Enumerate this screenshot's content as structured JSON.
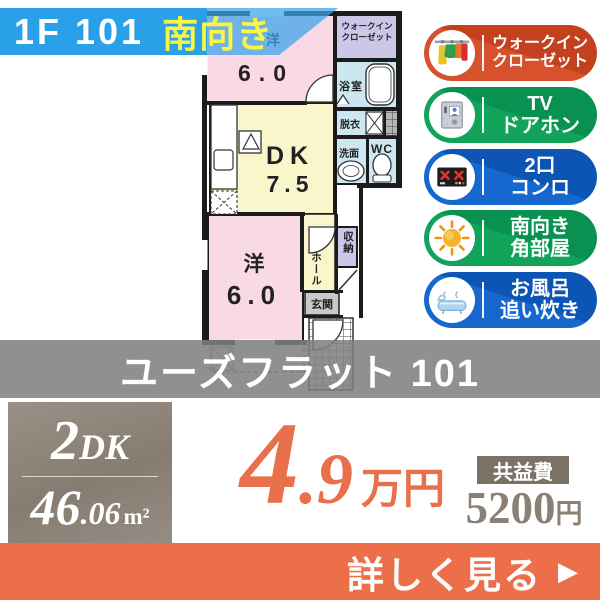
{
  "banner": {
    "unit": "1F 101",
    "direction": "南向き"
  },
  "floorplan": {
    "room1": {
      "name": "洋",
      "size": "6.0"
    },
    "wic": {
      "line1": "ウォークイン",
      "line2": "クローゼット"
    },
    "bath": "浴室",
    "dressing": "脱衣",
    "washroom": "洗面",
    "wc": "WC",
    "dk": {
      "name": "DK",
      "size": "7.5"
    },
    "room2": {
      "name": "洋",
      "size": "6.0"
    },
    "hall": "ホール",
    "storage": "収納",
    "entrance": "玄関"
  },
  "badges": [
    {
      "icon": "closet-icon",
      "line1": "ウォークイン",
      "line2": "クローゼット",
      "color": "#d7512c",
      "color_dark": "#c3411f"
    },
    {
      "icon": "doorphone-icon",
      "line1": "TV",
      "line2": "ドアホン",
      "color": "#12a35b",
      "color_dark": "#089150"
    },
    {
      "icon": "stove-icon",
      "line1": "2口",
      "line2": "コンロ",
      "color": "#1668ce",
      "color_dark": "#0d55b4"
    },
    {
      "icon": "sun-icon",
      "line1": "南向き",
      "line2": "角部屋",
      "color": "#12a35b",
      "color_dark": "#089150"
    },
    {
      "icon": "bathtub-icon",
      "line1": "お風呂",
      "line2": "追い炊き",
      "color": "#1668ce",
      "color_dark": "#0d55b4"
    }
  ],
  "property": {
    "name": "ユーズフラット 101"
  },
  "spec": {
    "layout_number": "2",
    "layout_type": "DK",
    "area_int": "46",
    "area_dec": ".06",
    "area_unit": "m²"
  },
  "rent": {
    "int": "4",
    "dec": ".9",
    "unit": "万円"
  },
  "fee": {
    "label": "共益費",
    "value": "5200",
    "unit": "円"
  },
  "cta": {
    "label": "詳しく見る",
    "arrow": "▶"
  },
  "colors": {
    "banner_blue": "#2aa0e8",
    "highlight_yellow": "#f8f640",
    "price_orange": "#e8714b",
    "cta_orange": "#ed6f4a",
    "name_band_gray": "rgba(128,128,128,0.87)",
    "spec_box_taupe": "#8f8479",
    "fee_box_taupe": "#7b7165",
    "plan_pink": "#f9d9e3",
    "plan_yellow": "#faf6cc",
    "plan_blue": "#cde7f2",
    "plan_lavender": "#cbc7e8"
  }
}
